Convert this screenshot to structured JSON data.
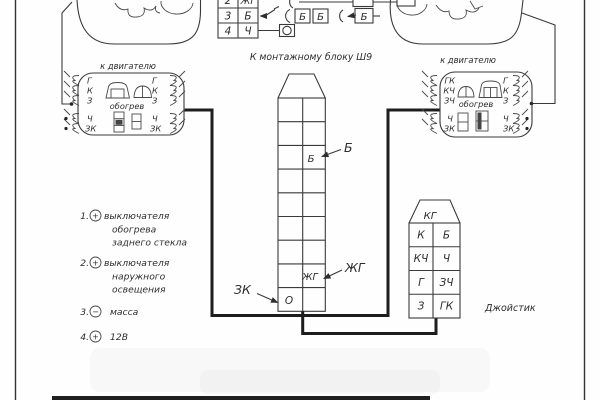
{
  "colors": {
    "line": "#3a3a3a",
    "text": "#2d2d2d",
    "wire": "#1d1d1d"
  },
  "top_table": {
    "rows": [
      {
        "num": "2",
        "code": "ЖГ"
      },
      {
        "num": "3",
        "code": "Б"
      },
      {
        "num": "4",
        "code": "Ч"
      }
    ],
    "wire_boxes": [
      "Б",
      "Б",
      "Б"
    ]
  },
  "central_block": {
    "title": "К монтажному блоку Ш9",
    "cell_b": "Б",
    "cell_zhg": "ЖГ",
    "cell_o": "О",
    "callout_b": "Б",
    "callout_zhg": "ЖГ",
    "callout_zk": "ЗК"
  },
  "left_connector": {
    "title": "к двигателю",
    "heater": "обогрев",
    "pins_left": [
      "Г",
      "К",
      "З",
      "Ч",
      "ЗК"
    ],
    "pins_right": [
      "Г",
      "К",
      "З",
      "Ч",
      "ЗК"
    ]
  },
  "right_connector": {
    "title": "к двигателю",
    "heater": "обогрев",
    "pins_left": [
      "ГК",
      "КЧ",
      "ЗЧ",
      "Ч",
      "ЗК"
    ],
    "pins_right": [
      "Г",
      "К",
      "З",
      "Ч",
      "ЗК"
    ]
  },
  "joystick": {
    "connector_label": "КГ",
    "caption": "Джойстик",
    "cells": [
      [
        "К",
        "Б"
      ],
      [
        "КЧ",
        "Ч"
      ],
      [
        "Г",
        "ЗЧ"
      ],
      [
        "З",
        "ГК"
      ]
    ]
  },
  "legend": {
    "items": [
      {
        "num": "1.",
        "sign": "+",
        "lines": [
          "выключателя",
          "обогрева",
          "заднего стекла"
        ]
      },
      {
        "num": "2.",
        "sign": "+",
        "lines": [
          "выключателя",
          "наружного",
          "освещения"
        ]
      },
      {
        "num": "3.",
        "sign": "−",
        "lines": [
          "масса"
        ]
      },
      {
        "num": "4.",
        "sign": "+",
        "lines": [
          "12В"
        ]
      }
    ]
  }
}
